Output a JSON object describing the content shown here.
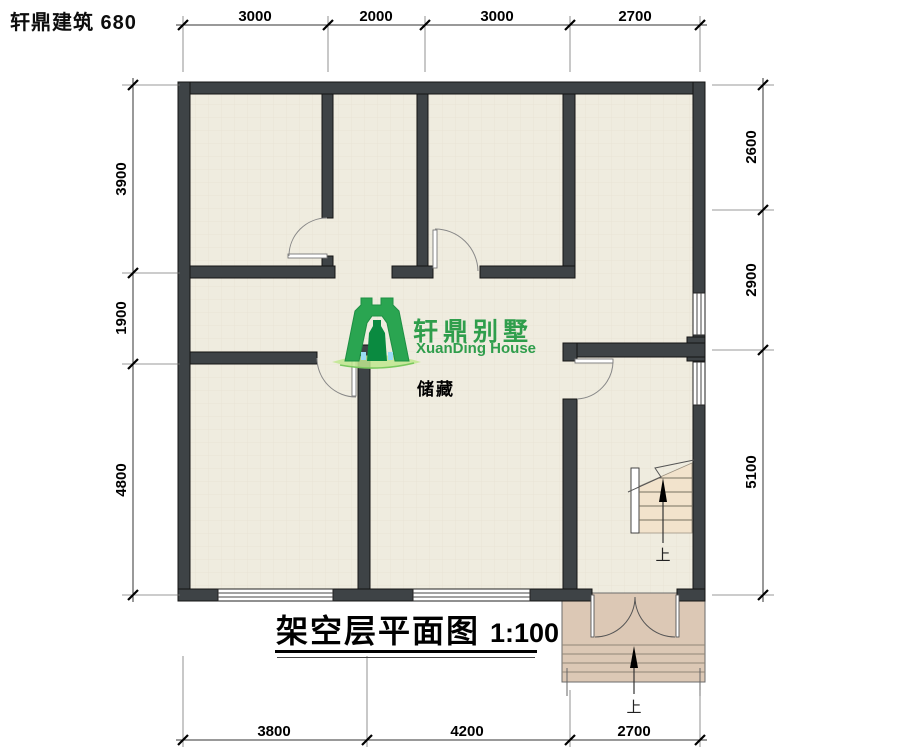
{
  "header": {
    "text": "轩鼎建筑 680"
  },
  "title": {
    "name": "架空层平面图",
    "scale": "1:100"
  },
  "logo": {
    "brand_cn": "轩鼎别墅",
    "brand_en": "XuanDing House",
    "green": "#2f9e4c",
    "dark_green": "#0a8a40",
    "light_blue": "#9bdcf5",
    "swoosh_green": "#bfe88f"
  },
  "room_labels": {
    "storage": "储藏"
  },
  "stair": {
    "up_label": "上"
  },
  "entry": {
    "up_label": "上"
  },
  "dimensions": {
    "top": [
      "3000",
      "2000",
      "3000",
      "2700"
    ],
    "bottom": [
      "3800",
      "4200",
      "2700"
    ],
    "left": [
      "3900",
      "1900",
      "4800"
    ],
    "right": [
      "2600",
      "2900",
      "5100"
    ]
  },
  "drawing": {
    "scale_ratio": "1:100",
    "total_width_mm": 10700,
    "total_depth_mm": 10600
  },
  "colors": {
    "wall": "#3e4346",
    "floor": "#efecdf",
    "floor_grid": "#e6e1d3",
    "porch": "#dcc8b5",
    "stair_tread": "#f2e3cc",
    "dim_line": "#333333"
  }
}
